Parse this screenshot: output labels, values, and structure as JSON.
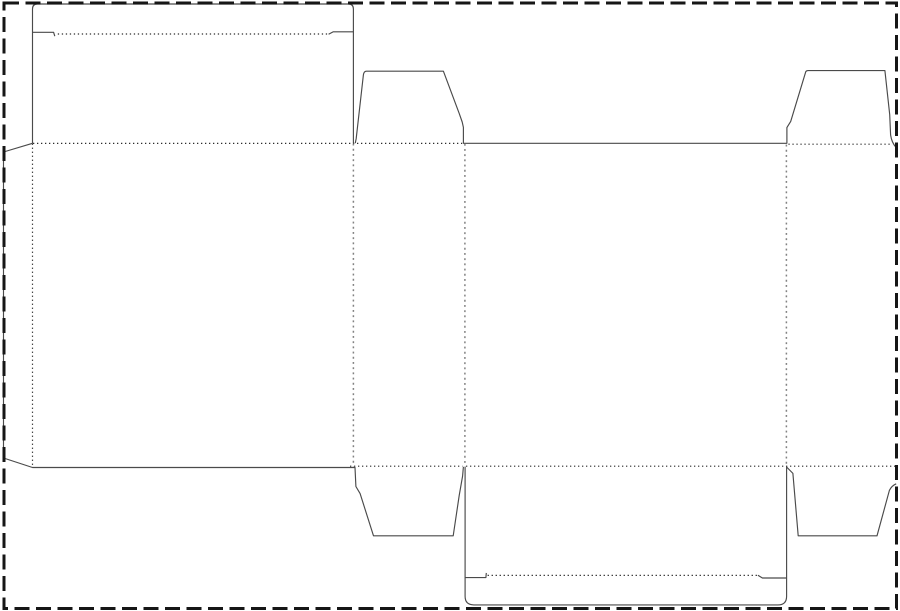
{
  "dieline": {
    "width": 900,
    "height": 611,
    "background": "#ffffff",
    "styles": {
      "cut": {
        "color": "#4a4a4a",
        "width": 1.15
      },
      "fold_fine": {
        "color": "#2d2d2d",
        "width": 1.2,
        "dash": "1.3 2.7"
      },
      "fold_coarse": {
        "color": "#828282",
        "width": 1.5,
        "dash": "1.9 3.3"
      }
    },
    "border": {
      "x": 4,
      "y": 3,
      "w": 892.5,
      "h": 605.5,
      "color": "#161616",
      "width": 3,
      "dash": "15 6.5"
    },
    "cut_paths": [
      {
        "name": "top-tuck-flap-outline-cut",
        "d": "M 32.5 143.3 L 32.5 9 Q 32.5 4 37.5 4 L 348.4 4 Q 353.4 4 353.4 9 L 353.4 143.3"
      },
      {
        "name": "top-tuck-slit-left-cut",
        "d": "M 32.5 32.3 L 53.6 32.3 L 54.8 36.2"
      },
      {
        "name": "top-tuck-slit-right-cut",
        "d": "M 353.4 31.8 L 333.3 31.8 L 328.6 34.2"
      },
      {
        "name": "glue-flap-front-bottom-dust-flap-left-cut",
        "d": "M 32.5 143.3 L 3.5 152 L 3.5 458 L 32.5 467.5 L 355 467.5 L 355.9 486.5 L 360.1 493.6 L 373.5 535.8 L 453.2 535.8 L 459.2 495.5 L 462.6 476 L 463.4 466.8"
      },
      {
        "name": "top-edge-dust-flaps-cut",
        "d": "M 355.3 143.1 L 356.2 138.5 L 363.4 74.8 Q 364 71.2 366.4 71.2 L 443.4 71.2 L 459.2 113.4 L 462.2 122 L 463.4 127.4 L 463.4 143.3 L 786.9 143.3 L 786.9 127.6 L 790.7 121.4 L 805.7 71.9 Q 806.3 70.6 808.2 70.6 L 884.9 70.6 L 889.7 114.5 L 890.6 135 Q 891.7 142.5 895.9 147.2"
      },
      {
        "name": "bottom-tuck-flap-outline-cut",
        "d": "M 465.1 466.6 L 465.1 596.3 Q 465.1 604.9 473.8 604.9 L 777.9 604.9 Q 786.6 604.9 786.6 596.2 L 786.6 466.6"
      },
      {
        "name": "bottom-tuck-slit-left-cut",
        "d": "M 465.1 577.6 L 485.9 577.6 L 486.3 572.9"
      },
      {
        "name": "bottom-tuck-slit-right-cut",
        "d": "M 786.6 578 L 762.4 578 L 757.9 575.2"
      },
      {
        "name": "bottom-right-dust-flap-cut",
        "d": "M 786.6 467 L 792.9 473.4 L 798.2 535.8 L 877 535.8 L 889.4 490.4 Q 891.6 485.8 896.2 483.8"
      }
    ],
    "fold_lines": [
      {
        "name": "top-tuck-crease-fold",
        "style": "fold_fine",
        "x1": 57.8,
        "y1": 34,
        "x2": 328,
        "y2": 34
      },
      {
        "name": "top-row-crease-fold",
        "style": "fold_fine",
        "x1": 33,
        "y1": 143.4,
        "x2": 462.2,
        "y2": 143.4
      },
      {
        "name": "top-right-dust-crease-fold",
        "style": "fold_fine",
        "x1": 788.4,
        "y1": 144.2,
        "x2": 892.4,
        "y2": 144.2
      },
      {
        "name": "glue-flap-crease-fold",
        "style": "fold_fine",
        "x1": 32.5,
        "y1": 143.6,
        "x2": 32.5,
        "y2": 466.4
      },
      {
        "name": "front-side-vertical-fold",
        "style": "fold_coarse",
        "x1": 353.4,
        "y1": 143.6,
        "x2": 353.4,
        "y2": 466.3
      },
      {
        "name": "side-back-vertical-fold",
        "style": "fold_coarse",
        "x1": 464.9,
        "y1": 143.8,
        "x2": 464.9,
        "y2": 466.3
      },
      {
        "name": "back-side-vertical-fold",
        "style": "fold_coarse",
        "x1": 786.4,
        "y1": 144.6,
        "x2": 786.4,
        "y2": 466.3
      },
      {
        "name": "bottom-row-crease-left-fold",
        "style": "fold_fine",
        "x1": 350,
        "y1": 466.2,
        "x2": 462.4,
        "y2": 466.2
      },
      {
        "name": "bottom-row-crease-right-fold",
        "style": "fold_fine",
        "x1": 466,
        "y1": 466.2,
        "x2": 896,
        "y2": 466.2
      },
      {
        "name": "bottom-tuck-crease-fold",
        "style": "fold_fine",
        "x1": 487.6,
        "y1": 575.4,
        "x2": 757.4,
        "y2": 575.4
      }
    ]
  }
}
